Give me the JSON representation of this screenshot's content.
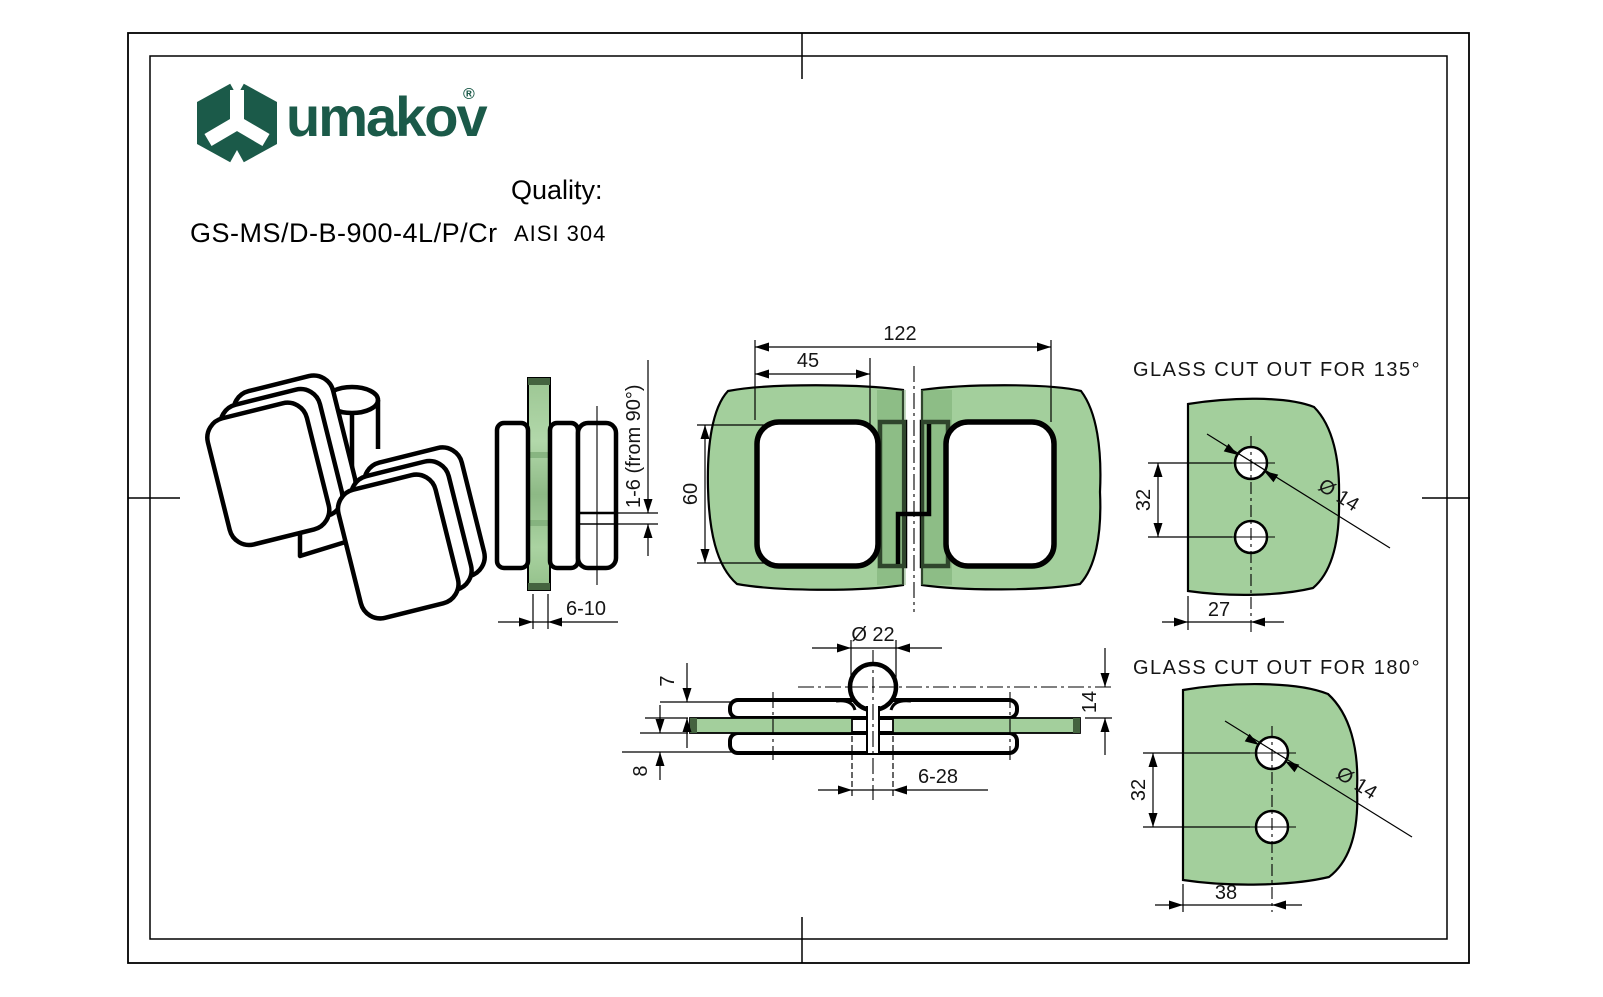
{
  "header": {
    "brand": "umakov",
    "registered": "®",
    "product_code": "GS-MS/D-B-900-4L/P/Cr",
    "quality_label": "Quality:",
    "quality_value": "AISI 304"
  },
  "colors": {
    "brand_green": "#1b5a49",
    "glass_green": "#a3cf9c",
    "glass_green_dark": "#86b07f",
    "line": "#000000"
  },
  "views": {
    "front": {
      "dim_total_width": "122",
      "dim_center_width": "45",
      "dim_height": "60"
    },
    "side": {
      "dim_adjust": "1-6 (from 90°)",
      "dim_glass_thickness": "6-10"
    },
    "section": {
      "dim_knuckle_dia": "Ø 22",
      "dim_plate_top": "7",
      "dim_pivot_height": "14",
      "dim_plate_bottom": "8",
      "dim_center_gap": "6-28"
    },
    "cutout_135": {
      "title": "GLASS CUT OUT FOR 135°",
      "dim_hole_spacing": "32",
      "dim_edge_distance": "27",
      "dim_hole_dia": "Ø 14"
    },
    "cutout_180": {
      "title": "GLASS CUT OUT FOR 180°",
      "dim_hole_spacing": "32",
      "dim_edge_distance": "38",
      "dim_hole_dia": "Ø 14"
    }
  }
}
